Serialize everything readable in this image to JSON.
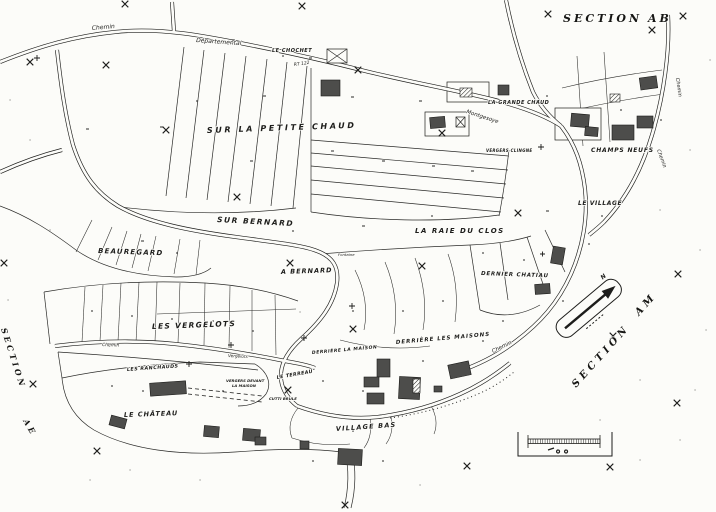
{
  "colors": {
    "paper": "#fcfcf9",
    "ink": "#1d1d1b",
    "building": "#4d4d4b"
  },
  "sections": {
    "ab_word": "SECTION",
    "ab_code": "AB",
    "am_word": "SECTION",
    "am_code": "AM",
    "ae_word": "SECTION",
    "ae_code": "AE"
  },
  "places": {
    "le_chochet": "LE CHOCHET",
    "sur_la_petite_chaud": "SUR LA PETITE CHAUD",
    "la_grande_chaud": "LA GRANDE CHAUD",
    "vergers_clingne": "VERGERS CLINGNE",
    "champs_neufs": "CHAMPS NEUFS",
    "le_village": "LE VILLAGE",
    "sur_bernard": "SUR BERNARD",
    "la_raie_du_clos": "LA RAIE DU CLOS",
    "beauregard": "BEAUREGARD",
    "dernier_chatiau": "DERNIER CHATIAU",
    "a_bernard": "A BERNARD",
    "les_vergelots": "LES VERGELOTS",
    "derriere_les_maisons": "DERRIÈRE LES MAISONS",
    "derriere_la_maison": "DERRIÈRE LA MAISON",
    "le_terreau": "LE TERREAU",
    "les_ranchauds": "LES RANCHAUDS",
    "vergers_devant_line1": "VERGERS DEVANT",
    "vergers_devant_line2": "LA MAISON",
    "cutti_brule": "CUTTI BRULE",
    "le_chateau": "LE CHÂTEAU",
    "village_bas": "VILLAGE BAS",
    "fontaine": "Fontaine"
  },
  "roads": {
    "chemin_top": "Chemin",
    "departemental": "Départemental",
    "rt_122": "RT 122",
    "montgesoye": "Montgesoye",
    "chemin_right_upper": "Chemin",
    "chemin_right_lower": "Chemin",
    "chemin_village": "Chemin",
    "chemin_vergelots": "Chemin",
    "vergelots_road": "Vergelots"
  },
  "map_marks": {
    "north_letter": "N"
  }
}
